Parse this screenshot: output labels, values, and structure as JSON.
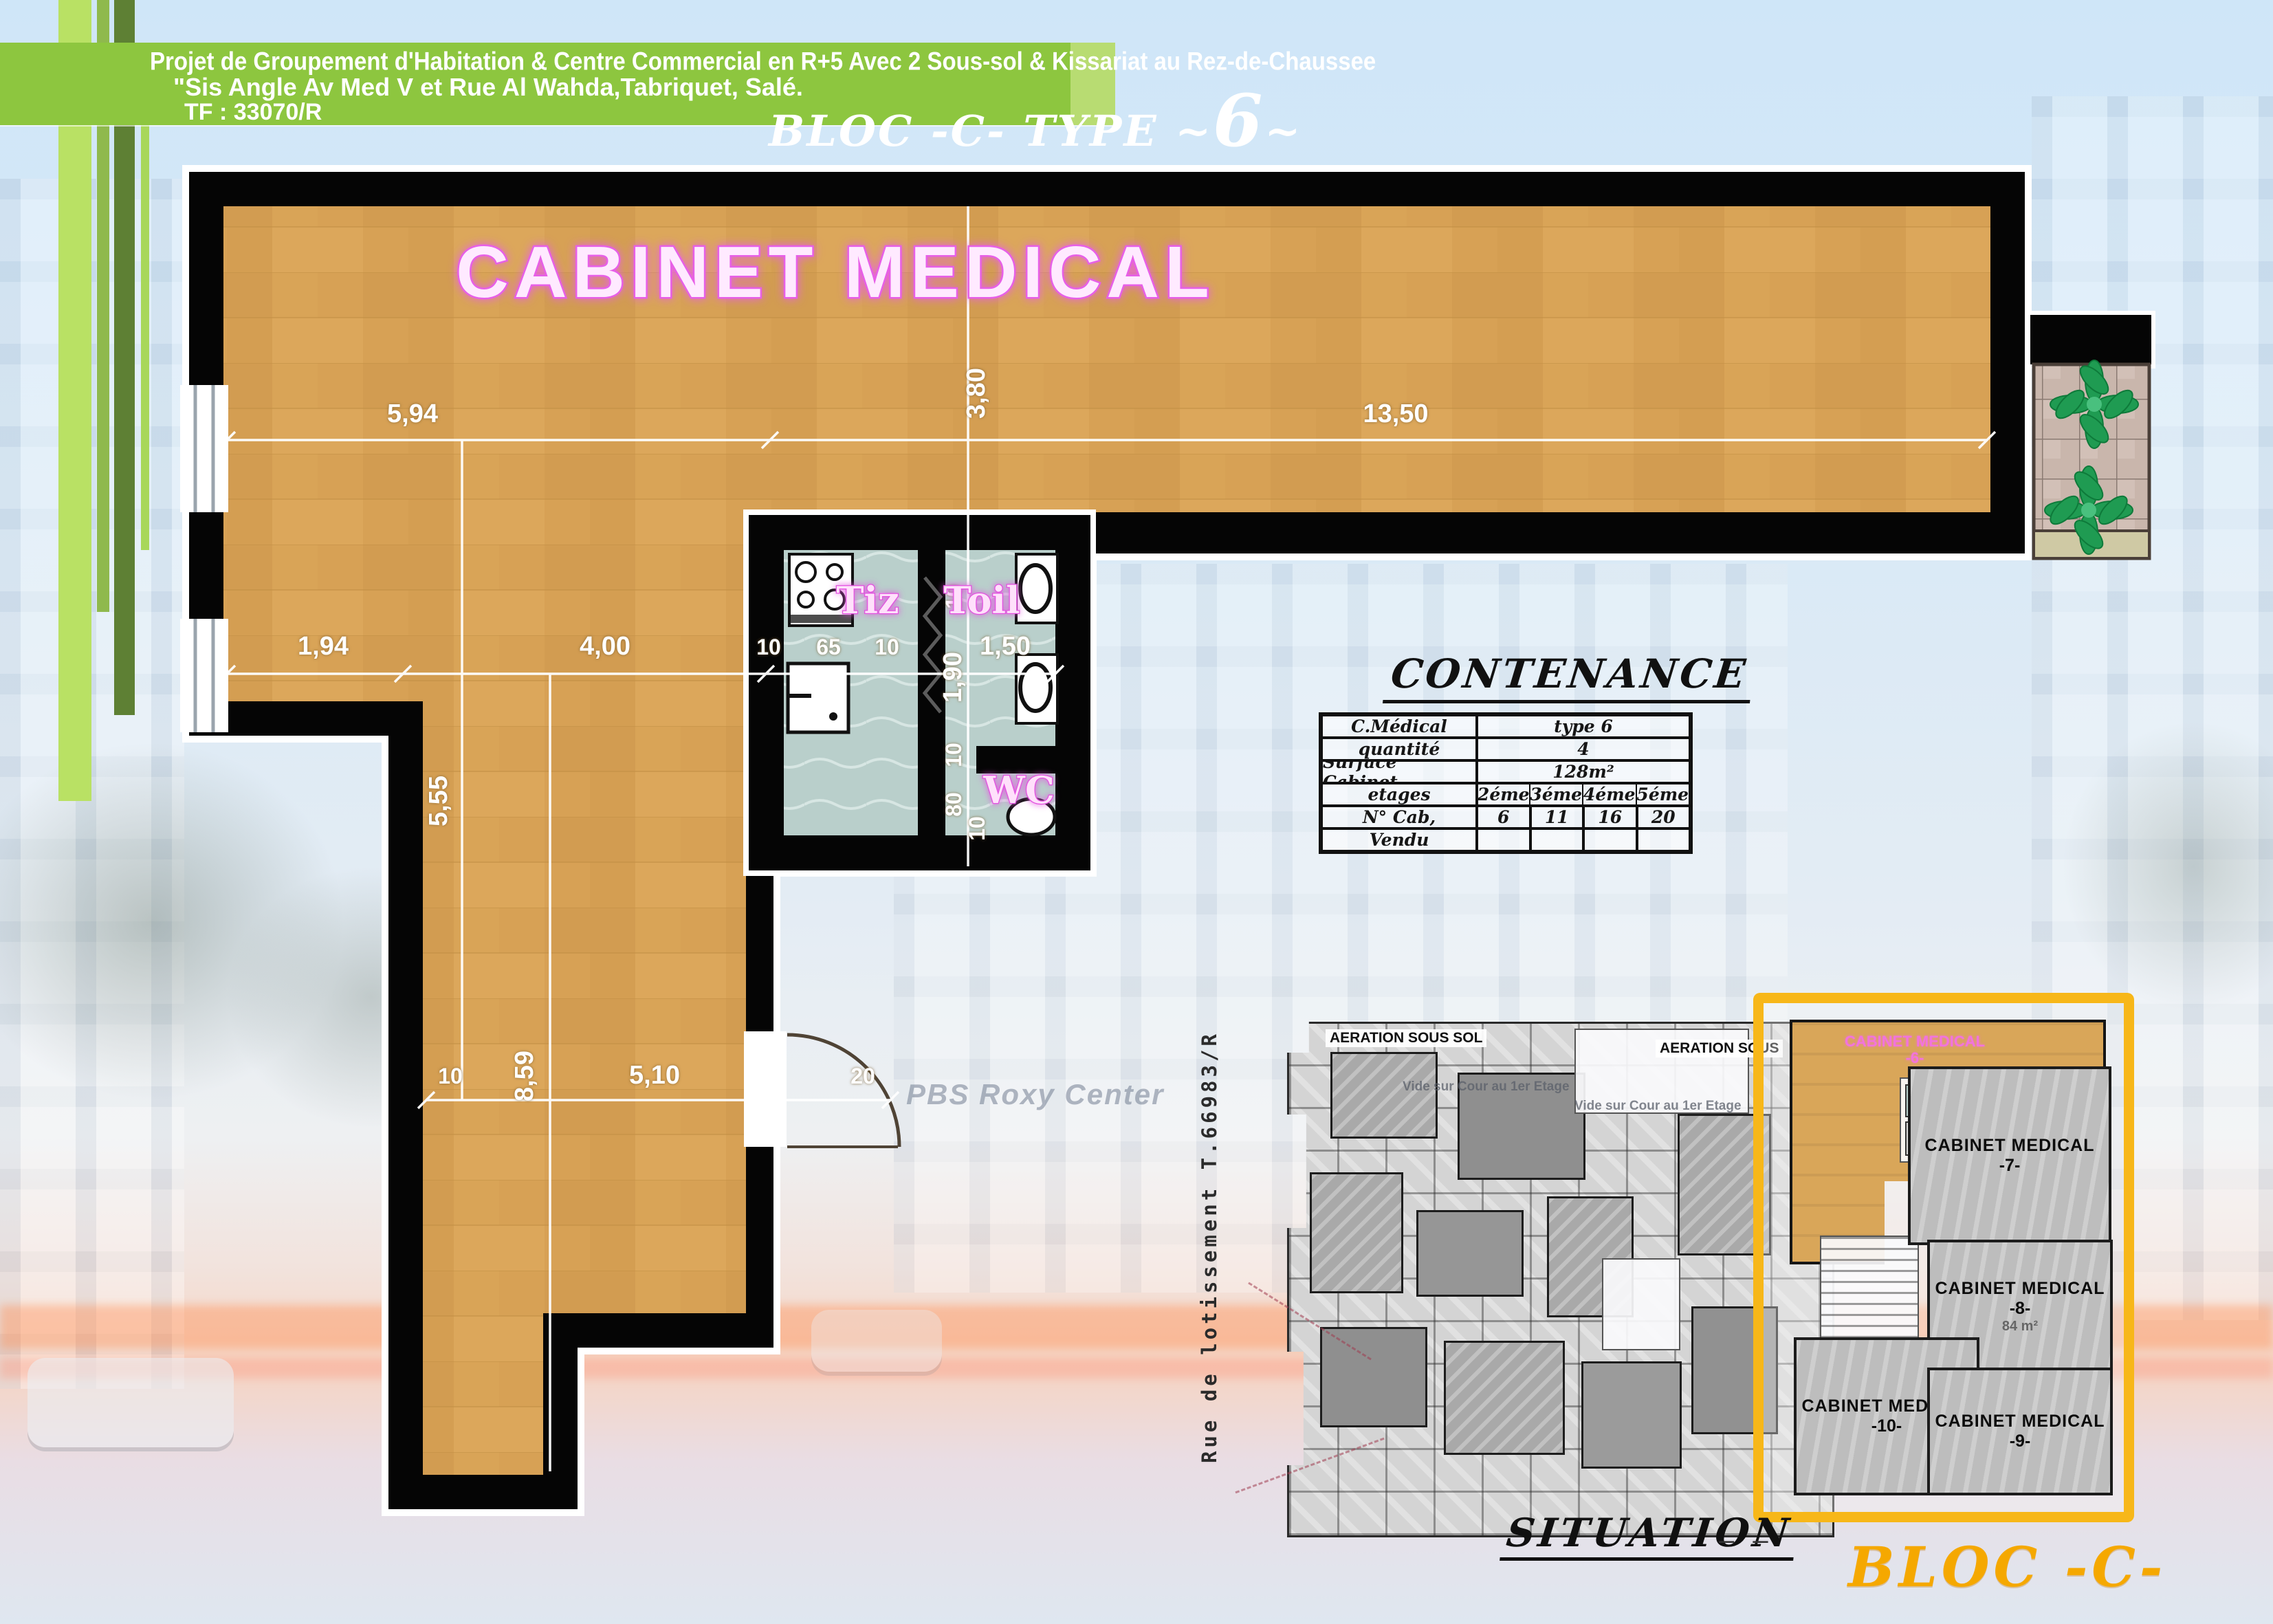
{
  "header": {
    "line1": "Projet de Groupement d'Habitation & Centre Commercial en R+5 Avec 2 Sous-sol & Kissariat au Rez-de-Chaussee",
    "line2": "\"Sis Angle Av Med V et Rue  Al Wahda,Tabriquet, Salé.",
    "line3": "TF : 33070/R",
    "bloc_type_prefix": "BLOC -C-   TYPE ~",
    "bloc_type_number": "6",
    "bloc_type_suffix": "~"
  },
  "plan": {
    "title": "CABINET MEDICAL",
    "room_tiz": "Tiz",
    "room_toil": "Toil",
    "room_wc": "WC",
    "watermark": "PBS Roxy Center",
    "dims": {
      "top_left": "5,94",
      "top_right": "13,50",
      "v_380": "3,80",
      "v_555": "5,55",
      "mid_194": "1,94",
      "mid_400": "4,00",
      "mid_10a": "10",
      "mid_65": "65",
      "mid_10b": "10",
      "mid_150": "1,50",
      "toil_10a": "10",
      "toil_190": "1,90",
      "toil_10b": "10",
      "wc_80": "80",
      "wc_10": "10",
      "bot_10": "10",
      "bot_859": "8,59",
      "bot_510": "5,10",
      "bot_20": "20"
    }
  },
  "contenance": {
    "title": "CONTENANCE",
    "rows": [
      {
        "label": "C.Médical",
        "value": "type 6"
      },
      {
        "label": "quantité",
        "value": "4"
      },
      {
        "label": "Surface Cabinet",
        "value": "128m²"
      },
      {
        "label": "etages",
        "c1": "2éme",
        "c2": "3éme",
        "c3": "4éme",
        "c4": "5éme"
      },
      {
        "label": "N° Cab,",
        "c1": "6",
        "c2": "11",
        "c3": "16",
        "c4": "20"
      },
      {
        "label": "Vendu",
        "c1": "",
        "c2": "",
        "c3": "",
        "c4": ""
      }
    ]
  },
  "situation": {
    "title": "SITUATION",
    "title_dashes": "– –",
    "bloc_label": "BLOC -C-",
    "street_label": "Rue de lotissement T.66983/R",
    "aeration_1": "AERATION SOUS SOL",
    "aeration_2": "AERATION SOUS",
    "vide_1": "Vide sur Cour au 1er Etage",
    "vide_2": "Vide sur Cour au 1er Etage",
    "units": {
      "u6": {
        "name": "CABINET MEDICAL",
        "num": "-6-"
      },
      "u7": {
        "name": "CABINET MEDICAL",
        "num": "-7-"
      },
      "u8": {
        "name": "CABINET MEDICAL",
        "num": "-8-",
        "area": "84 m²"
      },
      "u9": {
        "name": "CABINET MEDICAL",
        "num": "-9-"
      },
      "u10": {
        "name": "CABINET MEDICAL",
        "num": "-10-"
      }
    }
  },
  "colors": {
    "banner_green": "#8dc63f",
    "wood_floor": "#d7a155",
    "wall_black": "#000000",
    "wet_room_floor": "#b9cfcb",
    "pink_label": "#e34fe0",
    "dim_text": "#ffffff",
    "bloc_frame_orange": "#f7b719",
    "bloc_text_orange": "#f5a800"
  }
}
